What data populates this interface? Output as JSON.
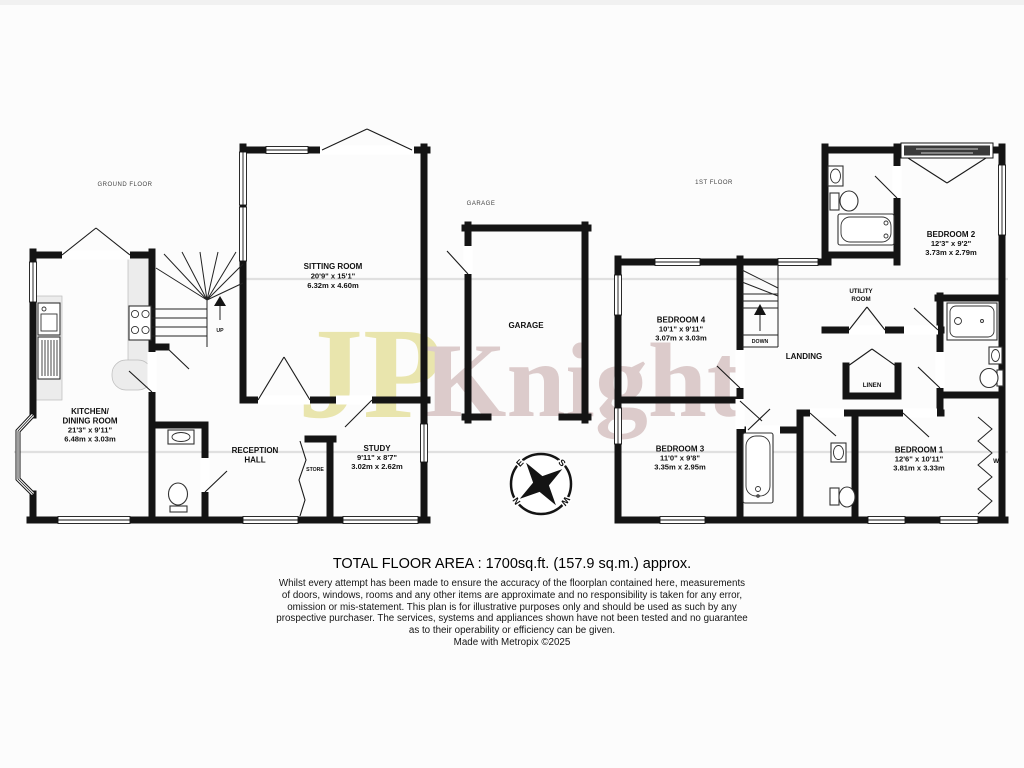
{
  "labels": {
    "ground_floor": "GROUND FLOOR",
    "first_floor": "1ST FLOOR",
    "garage_header": "GARAGE"
  },
  "watermark": {
    "left": "JP",
    "right": "Knight"
  },
  "rooms": {
    "sitting": {
      "name": "SITTING ROOM",
      "imperial": "20'9\" x 15'1\"",
      "metric": "6.32m x 4.60m"
    },
    "kitchen": {
      "name1": "KITCHEN/",
      "name2": "DINING ROOM",
      "imperial": "21'3\" x 9'11\"",
      "metric": "6.48m x 3.03m"
    },
    "reception": {
      "name1": "RECEPTION",
      "name2": "HALL"
    },
    "study": {
      "name": "STUDY",
      "imperial": "9'11\" x 8'7\"",
      "metric": "3.02m x 2.62m"
    },
    "store": {
      "name": "STORE"
    },
    "garage": {
      "name": "GARAGE"
    },
    "bedroom4": {
      "name": "BEDROOM 4",
      "imperial": "10'1\" x 9'11\"",
      "metric": "3.07m x 3.03m"
    },
    "landing": {
      "name": "LANDING"
    },
    "utility": {
      "name1": "UTILITY",
      "name2": "ROOM"
    },
    "bedroom2": {
      "name": "BEDROOM 2",
      "imperial": "12'3\" x 9'2\"",
      "metric": "3.73m x 2.79m"
    },
    "bedroom3": {
      "name": "BEDROOM 3",
      "imperial": "11'0\" x 9'8\"",
      "metric": "3.35m x 2.95m"
    },
    "bedroom1": {
      "name": "BEDROOM 1",
      "imperial": "12'6\" x 10'11\"",
      "metric": "3.81m x 3.33m"
    },
    "linen": {
      "name": "LINEN"
    },
    "wardrobe": {
      "name": "W"
    }
  },
  "stairs": {
    "up": "UP",
    "down": "DOWN"
  },
  "compass": {
    "north": "N",
    "south": "S",
    "east": "E",
    "west": "W"
  },
  "footer": {
    "total_area": "TOTAL FLOOR AREA : 1700sq.ft. (157.9 sq.m.) approx.",
    "disclaimer": [
      "Whilst every attempt has been made to ensure the accuracy of the floorplan contained here, measurements",
      "of doors, windows, rooms and any other items are approximate and no responsibility is taken for any error,",
      "omission or mis-statement. This plan is for illustrative purposes only and should be used as such by any",
      "prospective purchaser. The services, systems and appliances shown have not been tested and no guarantee",
      "as to their operability or efficiency can be given."
    ],
    "credit": "Made with Metropix ©2025"
  }
}
